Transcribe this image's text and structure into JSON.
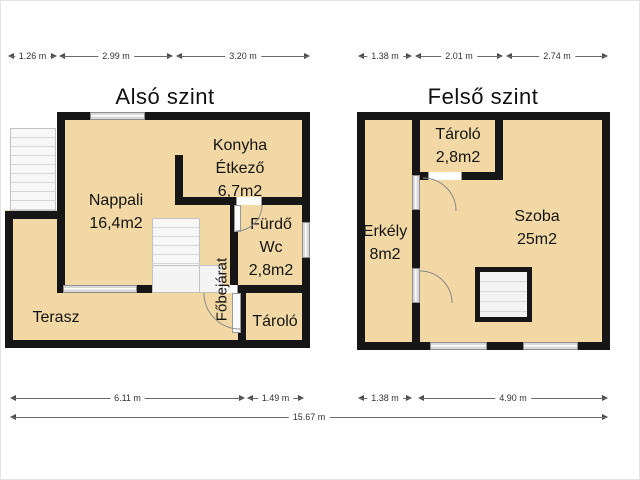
{
  "total_dim": "15.67 m",
  "colors": {
    "room_fill": "#f2d8a5",
    "wall": "#161616",
    "window": "#d8d8d8",
    "background": "#ffffff",
    "dim_line": "#6b6b6b"
  },
  "floors": {
    "lower": {
      "title": "Alsó szint",
      "dims_top": [
        "1.26 m",
        "2.99 m",
        "3.20 m"
      ],
      "dims_bottom": [
        "6.11 m",
        "1.49 m"
      ],
      "rooms": {
        "nappali": {
          "name": "Nappali",
          "area": "16,4m2"
        },
        "konyha": {
          "name": "Konyha",
          "name2": "Étkező",
          "area": "6,7m2"
        },
        "furdo": {
          "name": "Fürdő",
          "name2": "Wc",
          "area": "2,8m2"
        },
        "terasz": {
          "name": "Terasz"
        },
        "tarolo": {
          "name": "Tároló"
        },
        "fobejarat": {
          "name": "Főbejárat"
        }
      }
    },
    "upper": {
      "title": "Felső szint",
      "dims_top": [
        "1.38 m",
        "2.01 m",
        "2.74 m"
      ],
      "dims_bottom": [
        "1.38 m",
        "4.90 m"
      ],
      "rooms": {
        "tarolo": {
          "name": "Tároló",
          "area": "2,8m2"
        },
        "szoba": {
          "name": "Szoba",
          "area": "25m2"
        },
        "erkely": {
          "name": "Erkély",
          "area": "8m2"
        }
      }
    }
  }
}
